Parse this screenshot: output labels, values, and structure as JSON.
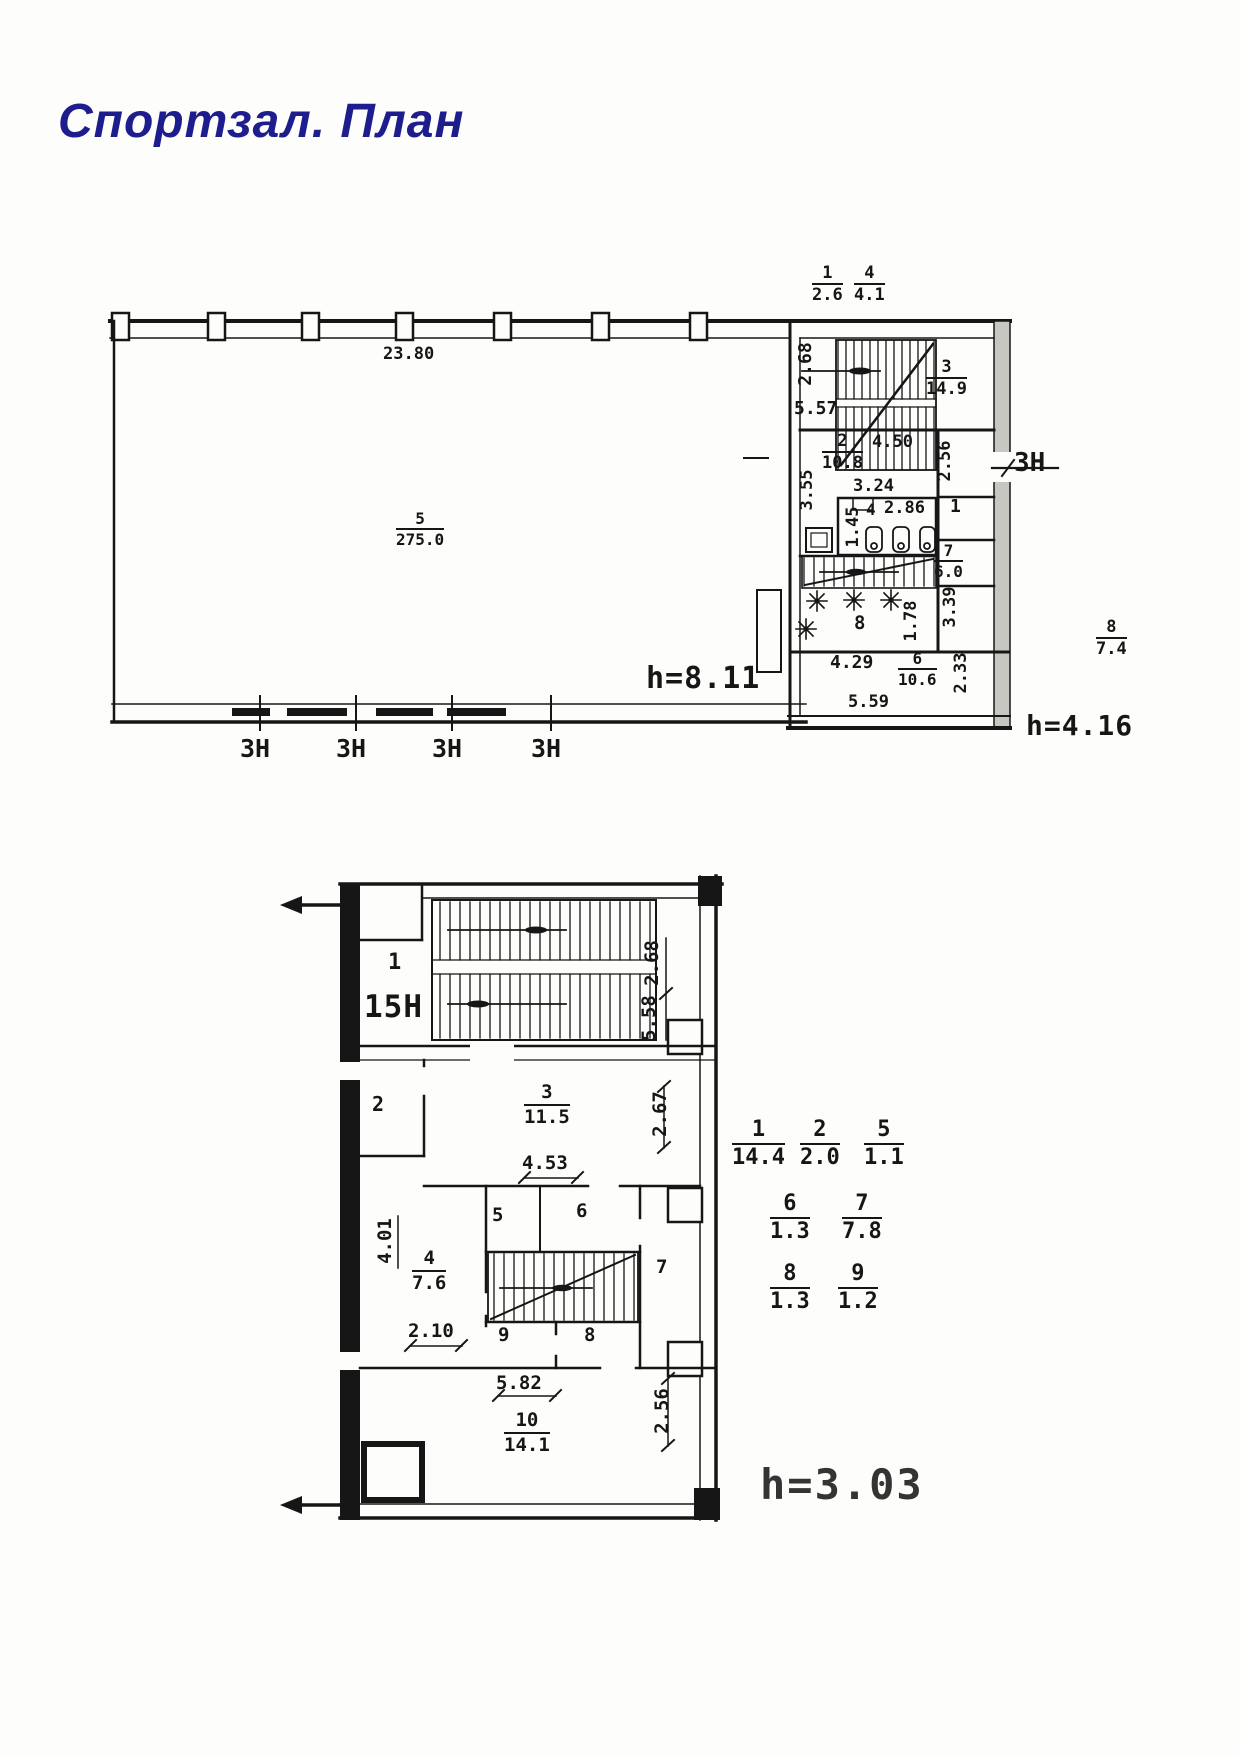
{
  "title": "Спортзал. План",
  "upper_plan": {
    "hall": {
      "room": {
        "num": "5",
        "den": "275.0"
      },
      "top_dim": "23.80",
      "height": "h=8.11",
      "window_labels": [
        "ЗН",
        "ЗН",
        "ЗН",
        "ЗН"
      ]
    },
    "annex": {
      "height": "h=4.16",
      "door_label": "ЗН",
      "top_fracs": [
        {
          "num": "1",
          "den": "2.6"
        },
        {
          "num": "4",
          "den": "4.1"
        }
      ],
      "side_frac": {
        "num": "8",
        "den": "7.4"
      },
      "stair_room": {
        "frac": {
          "num": "3",
          "den": "14.9"
        },
        "dims": {
          "w": "5.57",
          "h": "2.68"
        }
      },
      "room2": {
        "frac": {
          "num": "2",
          "den": "10.8"
        },
        "dims": {
          "top": "4.50",
          "mid": "3.24",
          "left": "3.55",
          "right": "2.56"
        }
      },
      "room4": {
        "number": "4",
        "dims": {
          "left": "1.45",
          "top": "2.86"
        }
      },
      "room1": {
        "number": "1"
      },
      "room7": {
        "frac": {
          "num": "7",
          "den": "6.0"
        },
        "dim_below": "3.39"
      },
      "room8": {
        "number": "8",
        "dims": {
          "right": "1.78",
          "bottom": "4.29"
        }
      },
      "room6": {
        "frac": {
          "num": "6",
          "den": "10.6"
        },
        "dims": {
          "bottom": "5.59",
          "right": "2.33"
        }
      }
    }
  },
  "lower_plan": {
    "height": "h=3.03",
    "unit_label": "15Н",
    "rooms": {
      "r1": "1",
      "r2": "2",
      "r5": "5",
      "r6": "6",
      "r7": "7",
      "r8": "8",
      "r9": "9",
      "r3": {
        "num": "3",
        "den": "11.5"
      },
      "r4": {
        "num": "4",
        "den": "7.6"
      },
      "r10": {
        "num": "10",
        "den": "14.1"
      }
    },
    "dims": {
      "d268": "2.68",
      "d558": "5.58",
      "d267": "2.67",
      "d453": "4.53",
      "d401": "4.01",
      "d210": "2.10",
      "d582": "5.82",
      "d256": "2.56"
    },
    "area_table": {
      "row1": [
        {
          "num": "1",
          "den": "14.4"
        },
        {
          "num": "2",
          "den": "2.0"
        },
        {
          "num": "5",
          "den": "1.1"
        }
      ],
      "row2": [
        {
          "num": "6",
          "den": "1.3"
        },
        {
          "num": "7",
          "den": "7.8"
        }
      ],
      "row3": [
        {
          "num": "8",
          "den": "1.3"
        },
        {
          "num": "9",
          "den": "1.2"
        }
      ]
    }
  },
  "colors": {
    "title": "#1d1d8e",
    "ink": "#161616",
    "paper": "#fdfdfb"
  }
}
